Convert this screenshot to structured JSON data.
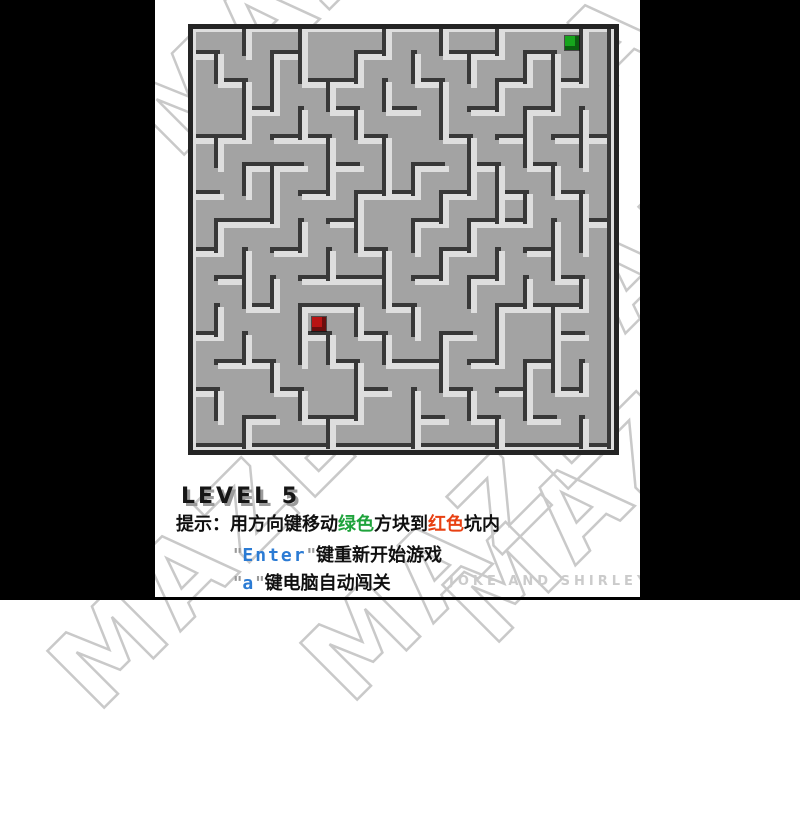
{
  "background": {
    "left_bar_color": "#000000",
    "right_bar_color": "#000000",
    "content_color": "#ffffff"
  },
  "watermark": {
    "text": "MAZE",
    "color": "#c9c9c9",
    "rotation_deg": -45,
    "instances": [
      {
        "x": 285,
        "y": 0
      },
      {
        "x": 628,
        "y": 22
      },
      {
        "x": 650,
        "y": 255
      },
      {
        "x": 600,
        "y": 487
      },
      {
        "x": 205,
        "y": 553
      },
      {
        "x": 458,
        "y": 545
      }
    ]
  },
  "maze": {
    "grid": {
      "cols": 15,
      "rows": 15,
      "cell_px": 28.07
    },
    "colors": {
      "floor": "#a3a3a3",
      "wall_face": "#dedede",
      "wall_shadow": "#383838",
      "rim": "#242424"
    },
    "player": {
      "name": "green-square",
      "color": "#16a51c",
      "shade": "#0b5f10",
      "col": 13,
      "row": 0
    },
    "target": {
      "name": "red-square",
      "color": "#b91313",
      "shade": "#6b0d0d",
      "col": 4,
      "row": 10
    },
    "walls": {
      "h": [
        [
          0,
          0,
          15
        ],
        [
          1,
          0,
          1
        ],
        [
          1,
          3,
          4
        ],
        [
          1,
          6,
          7
        ],
        [
          1,
          9,
          11
        ],
        [
          1,
          12,
          13
        ],
        [
          2,
          1,
          2
        ],
        [
          2,
          4,
          6
        ],
        [
          2,
          8,
          9
        ],
        [
          2,
          11,
          12
        ],
        [
          2,
          13,
          14
        ],
        [
          3,
          2,
          3
        ],
        [
          3,
          5,
          6
        ],
        [
          3,
          7,
          8
        ],
        [
          3,
          10,
          11
        ],
        [
          3,
          12,
          13
        ],
        [
          4,
          0,
          2
        ],
        [
          4,
          3,
          5
        ],
        [
          4,
          6,
          7
        ],
        [
          4,
          9,
          10
        ],
        [
          4,
          11,
          12
        ],
        [
          4,
          13,
          15
        ],
        [
          5,
          2,
          4
        ],
        [
          5,
          5,
          6
        ],
        [
          5,
          8,
          9
        ],
        [
          5,
          10,
          11
        ],
        [
          5,
          12,
          13
        ],
        [
          6,
          0,
          1
        ],
        [
          6,
          4,
          5
        ],
        [
          6,
          6,
          8
        ],
        [
          6,
          9,
          10
        ],
        [
          6,
          11,
          12
        ],
        [
          6,
          13,
          14
        ],
        [
          7,
          1,
          3
        ],
        [
          7,
          5,
          6
        ],
        [
          7,
          8,
          9
        ],
        [
          7,
          10,
          12
        ],
        [
          7,
          14,
          15
        ],
        [
          8,
          0,
          1
        ],
        [
          8,
          3,
          4
        ],
        [
          8,
          6,
          7
        ],
        [
          8,
          9,
          10
        ],
        [
          8,
          12,
          13
        ],
        [
          9,
          1,
          2
        ],
        [
          9,
          4,
          7
        ],
        [
          9,
          8,
          9
        ],
        [
          9,
          10,
          11
        ],
        [
          9,
          13,
          14
        ],
        [
          10,
          2,
          3
        ],
        [
          10,
          4,
          6
        ],
        [
          10,
          7,
          8
        ],
        [
          10,
          11,
          14
        ],
        [
          11,
          0,
          1
        ],
        [
          11,
          4,
          5
        ],
        [
          11,
          6,
          7
        ],
        [
          11,
          9,
          10
        ],
        [
          11,
          13,
          14
        ],
        [
          12,
          1,
          3
        ],
        [
          12,
          5,
          6
        ],
        [
          12,
          7,
          9
        ],
        [
          12,
          10,
          11
        ],
        [
          12,
          12,
          13
        ],
        [
          13,
          0,
          1
        ],
        [
          13,
          3,
          4
        ],
        [
          13,
          6,
          7
        ],
        [
          13,
          9,
          10
        ],
        [
          13,
          11,
          12
        ],
        [
          13,
          13,
          14
        ],
        [
          14,
          2,
          3
        ],
        [
          14,
          4,
          6
        ],
        [
          14,
          8,
          9
        ],
        [
          14,
          10,
          11
        ],
        [
          14,
          12,
          13
        ],
        [
          15,
          0,
          15
        ]
      ],
      "v": [
        [
          0,
          0,
          15
        ],
        [
          1,
          1,
          2
        ],
        [
          1,
          4,
          5
        ],
        [
          1,
          7,
          8
        ],
        [
          1,
          10,
          11
        ],
        [
          1,
          13,
          14
        ],
        [
          2,
          0,
          1
        ],
        [
          2,
          2,
          4
        ],
        [
          2,
          5,
          6
        ],
        [
          2,
          8,
          10
        ],
        [
          2,
          11,
          12
        ],
        [
          2,
          14,
          15
        ],
        [
          3,
          1,
          3
        ],
        [
          3,
          5,
          7
        ],
        [
          3,
          9,
          10
        ],
        [
          3,
          12,
          13
        ],
        [
          4,
          0,
          2
        ],
        [
          4,
          3,
          4
        ],
        [
          4,
          7,
          8
        ],
        [
          4,
          10,
          12
        ],
        [
          4,
          13,
          14
        ],
        [
          5,
          2,
          3
        ],
        [
          5,
          4,
          6
        ],
        [
          5,
          8,
          9
        ],
        [
          5,
          11,
          12
        ],
        [
          5,
          14,
          15
        ],
        [
          6,
          1,
          2
        ],
        [
          6,
          3,
          4
        ],
        [
          6,
          6,
          8
        ],
        [
          6,
          10,
          11
        ],
        [
          6,
          12,
          14
        ],
        [
          7,
          0,
          1
        ],
        [
          7,
          2,
          3
        ],
        [
          7,
          4,
          6
        ],
        [
          7,
          8,
          10
        ],
        [
          7,
          11,
          12
        ],
        [
          8,
          1,
          2
        ],
        [
          8,
          5,
          6
        ],
        [
          8,
          7,
          8
        ],
        [
          8,
          10,
          11
        ],
        [
          8,
          13,
          15
        ],
        [
          9,
          0,
          1
        ],
        [
          9,
          2,
          4
        ],
        [
          9,
          6,
          7
        ],
        [
          9,
          8,
          9
        ],
        [
          9,
          11,
          13
        ],
        [
          10,
          1,
          2
        ],
        [
          10,
          4,
          6
        ],
        [
          10,
          7,
          8
        ],
        [
          10,
          9,
          10
        ],
        [
          10,
          13,
          14
        ],
        [
          11,
          0,
          1
        ],
        [
          11,
          2,
          3
        ],
        [
          11,
          5,
          7
        ],
        [
          11,
          8,
          9
        ],
        [
          11,
          10,
          12
        ],
        [
          11,
          14,
          15
        ],
        [
          12,
          1,
          2
        ],
        [
          12,
          3,
          5
        ],
        [
          12,
          6,
          7
        ],
        [
          12,
          9,
          10
        ],
        [
          12,
          12,
          14
        ],
        [
          13,
          1,
          3
        ],
        [
          13,
          5,
          6
        ],
        [
          13,
          7,
          9
        ],
        [
          13,
          10,
          13
        ],
        [
          14,
          0,
          2
        ],
        [
          14,
          3,
          5
        ],
        [
          14,
          6,
          8
        ],
        [
          14,
          9,
          10
        ],
        [
          14,
          12,
          13
        ],
        [
          14,
          14,
          15
        ],
        [
          15,
          0,
          15
        ]
      ]
    }
  },
  "hud": {
    "level_label": "LEVEL 5",
    "tip": {
      "prefix": "提示：用方向键移动",
      "green_word": "绿色",
      "mid": "方块到",
      "red_word": "红色",
      "suffix": "坑内"
    },
    "enter_line": {
      "q1": "\"",
      "key": "Enter",
      "q2": "\"",
      "rest": "键重新开始游戏"
    },
    "auto_line": {
      "q1": "\"",
      "key": "a",
      "q2": "\"",
      "rest": "键电脑自动闯关"
    },
    "credit": "JOKE AND SHIRLEY"
  }
}
